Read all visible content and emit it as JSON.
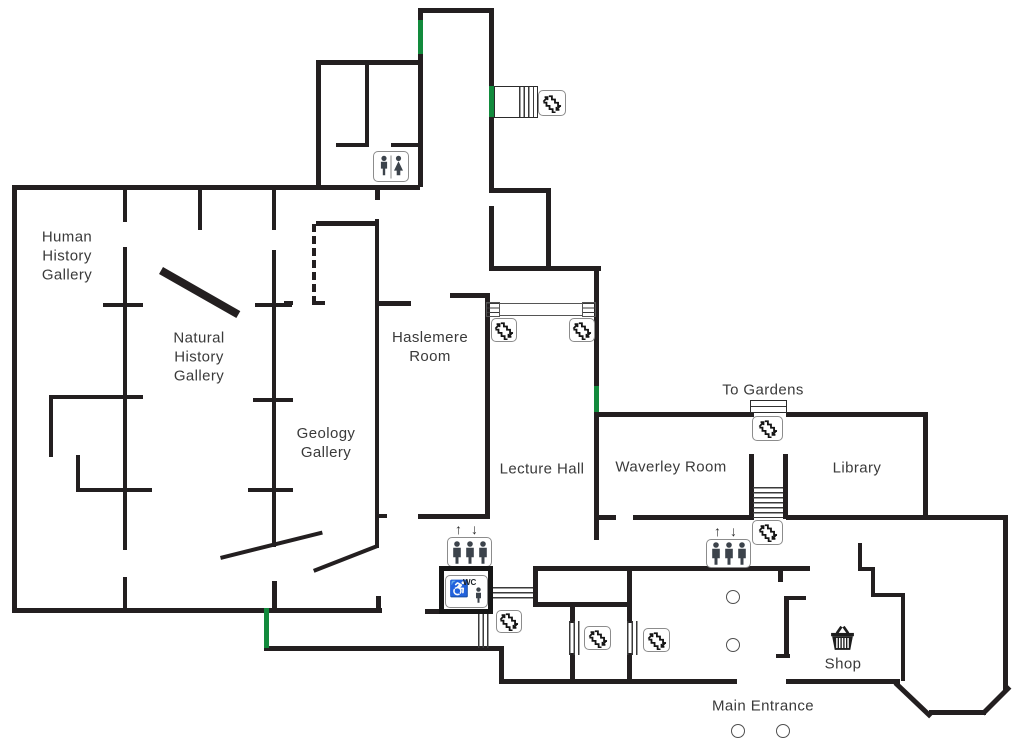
{
  "colors": {
    "background": "#ffffff",
    "wall": "#231f20",
    "door_marker_green": "#128a3c",
    "icon_figure": "#3c434b",
    "label_text": "#3a3a3a"
  },
  "rooms": {
    "human_history_gallery": [
      "Human",
      "History",
      "Gallery"
    ],
    "natural_history_gallery": [
      "Natural",
      "History",
      "Gallery"
    ],
    "geology_gallery": [
      "Geology",
      "Gallery"
    ],
    "haslemere_room": [
      "Haslemere",
      "Room"
    ],
    "lecture_hall": [
      "Lecture Hall"
    ],
    "waverley_room": [
      "Waverley Room"
    ],
    "library": [
      "Library"
    ],
    "shop": [
      "Shop"
    ]
  },
  "annotations": {
    "to_gardens": "To Gardens",
    "main_entrance": "Main Entrance"
  },
  "symbols": {
    "wc_label": "WC",
    "lift_up_arrow": "↑",
    "lift_down_arrow": "↓",
    "wheelchair": "♿",
    "icon_names": [
      "stairs-icon",
      "toilets-icon",
      "lift-icon",
      "accessible-wc-icon",
      "shopping-basket-icon",
      "column-circle",
      "door-marker"
    ]
  }
}
